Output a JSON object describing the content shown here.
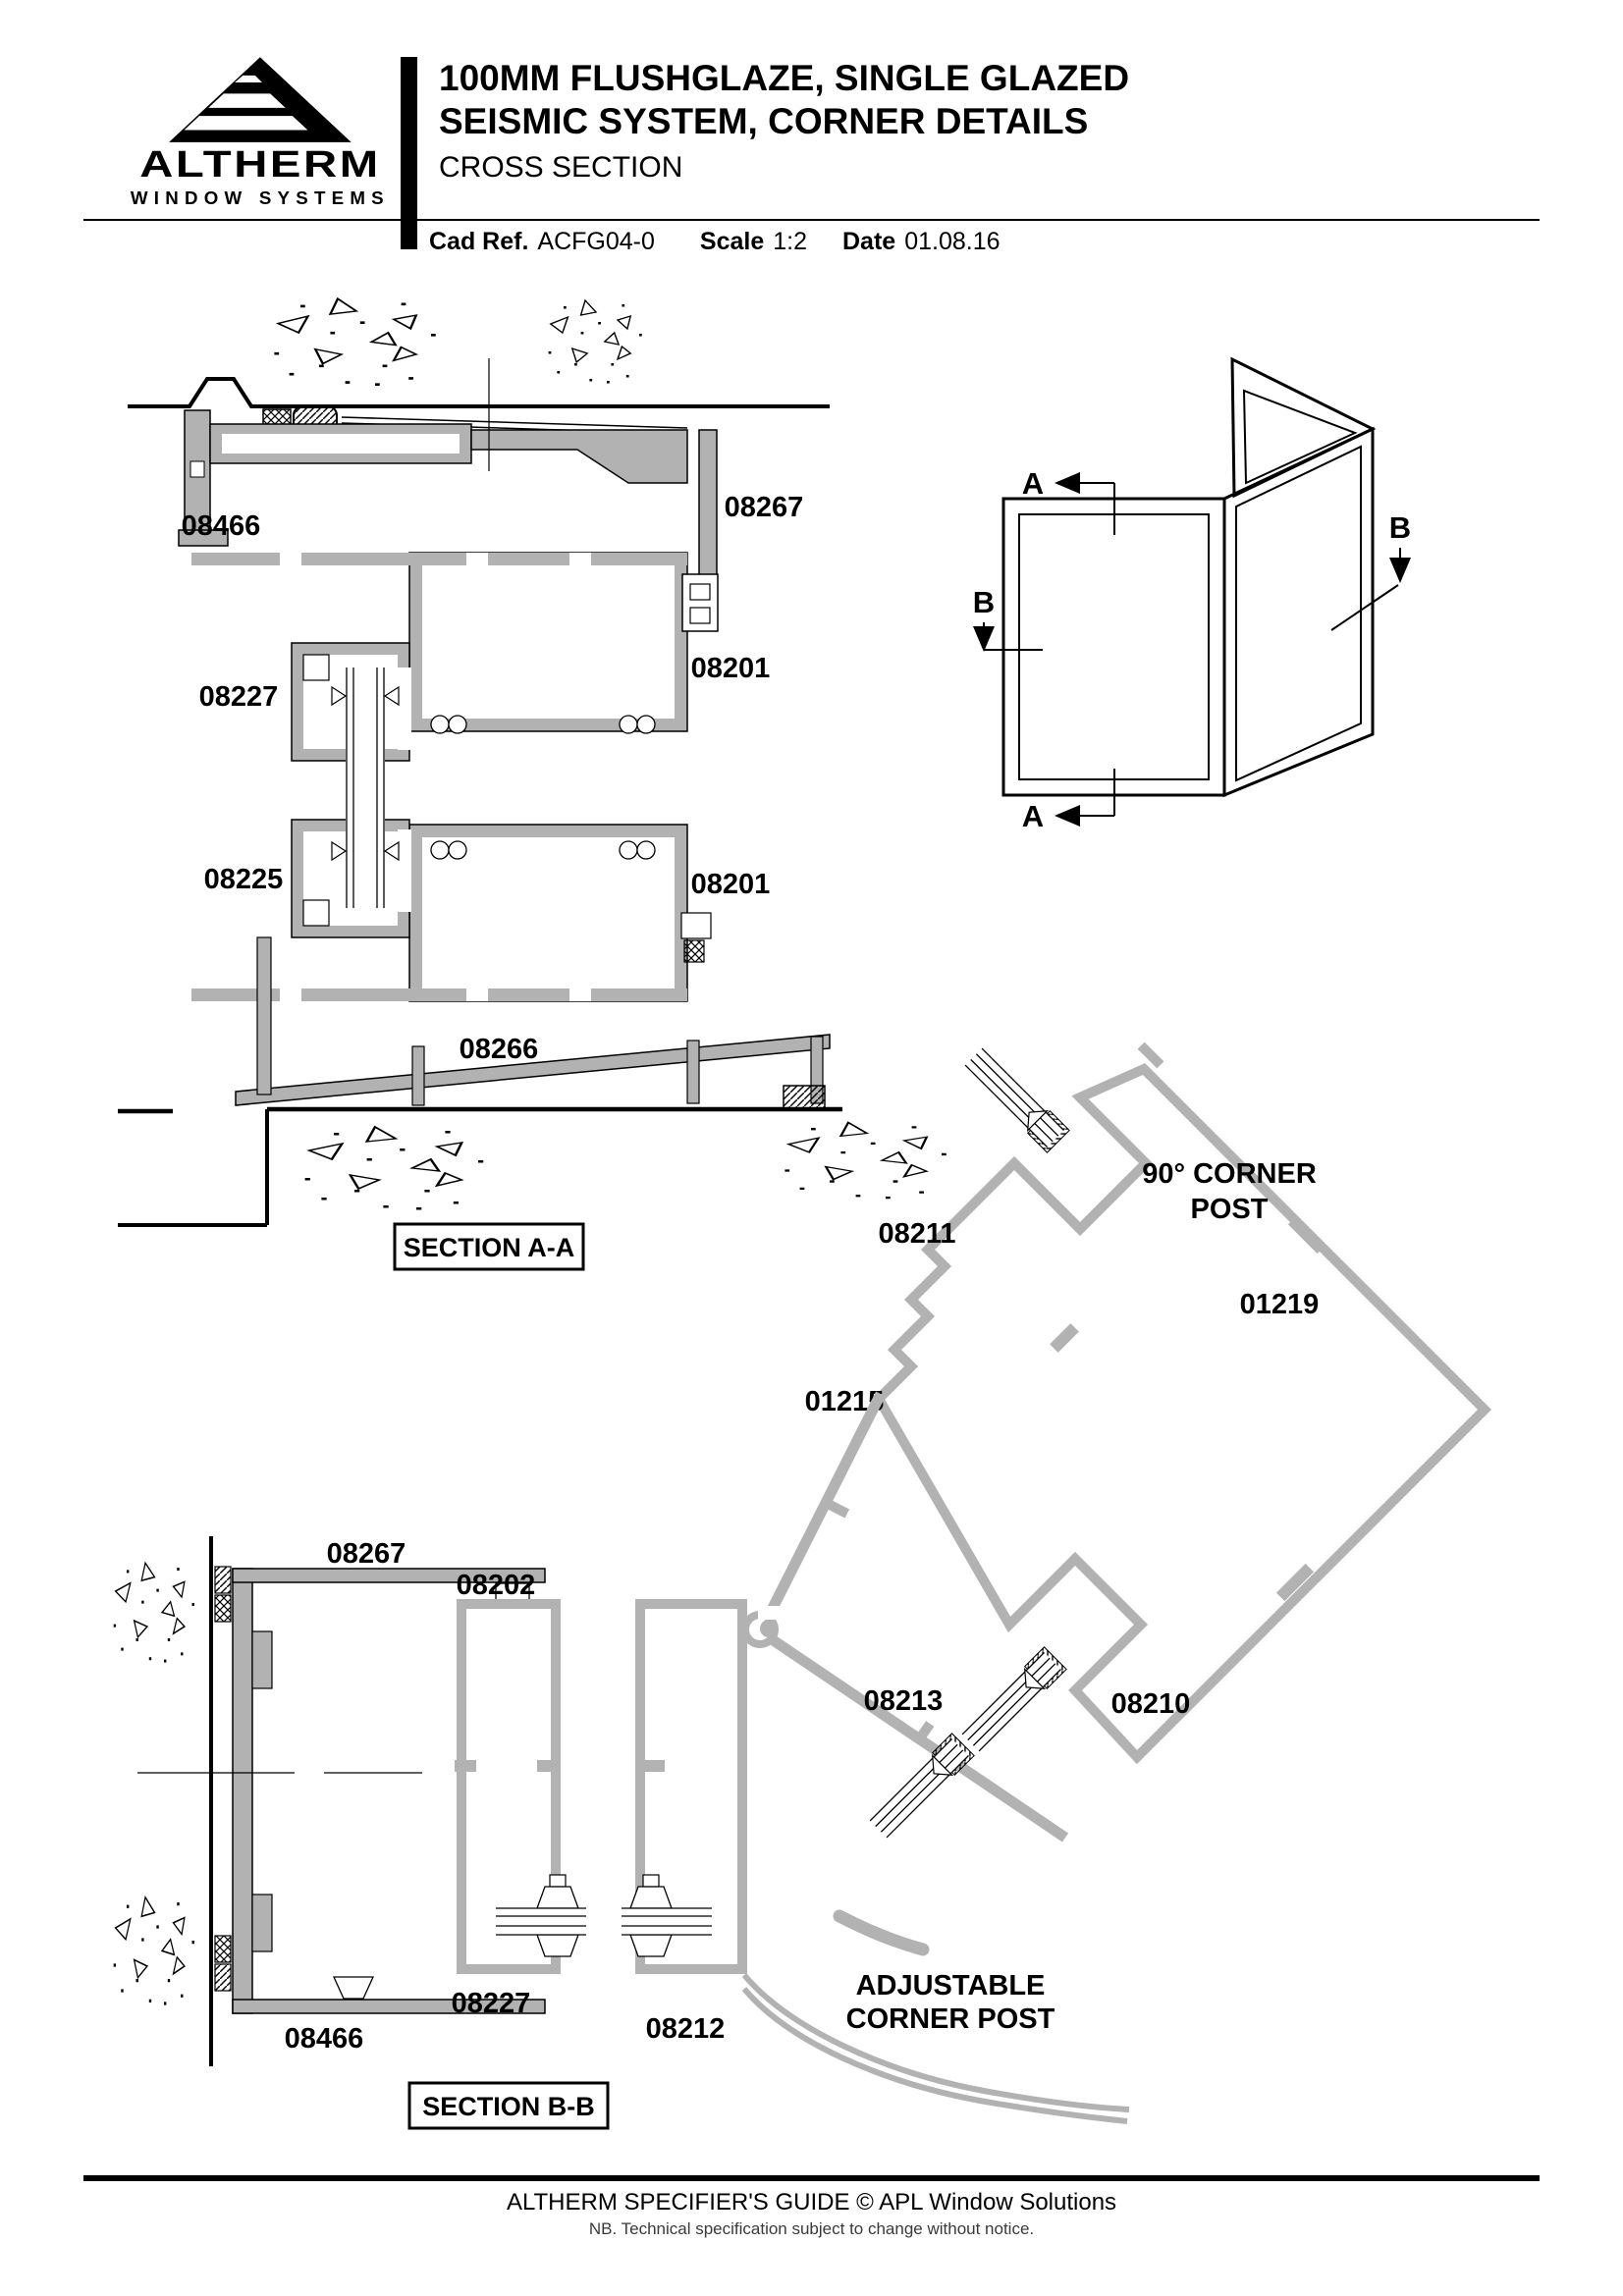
{
  "colors": {
    "ink": "#000000",
    "profile_gray": "#b2b2b2"
  },
  "header": {
    "brand": "ALTHERM",
    "brand_tagline": "WINDOW SYSTEMS",
    "title_line1": "100MM FLUSHGLAZE, SINGLE GLAZED",
    "title_line2": "SEISMIC SYSTEM, CORNER DETAILS",
    "subtitle": "CROSS SECTION",
    "cad_ref_label": "Cad Ref.",
    "cad_ref_value": "ACFG04-0",
    "scale_label": "Scale",
    "scale_value": "1:2",
    "date_label": "Date",
    "date_value": "01.08.16"
  },
  "section_aa": {
    "caption": "SECTION A-A",
    "part_08466": "08466",
    "part_08267": "08267",
    "part_08227": "08227",
    "part_08201_upper": "08201",
    "part_08225": "08225",
    "part_08201_lower": "08201",
    "part_08266": "08266"
  },
  "isometric": {
    "marker_a_top": "A",
    "marker_a_bottom": "A",
    "marker_b_left": "B",
    "marker_b_right": "B"
  },
  "corner_post_90": {
    "title_line1": "90° CORNER",
    "title_line2": "POST",
    "part_08211": "08211",
    "part_01219": "01219",
    "part_01215": "01215",
    "part_08210": "08210"
  },
  "adjustable_post": {
    "title_line1": "ADJUSTABLE",
    "title_line2": "CORNER POST",
    "part_08213": "08213",
    "part_08212": "08212"
  },
  "section_bb": {
    "caption": "SECTION B-B",
    "part_08267": "08267",
    "part_08202": "08202",
    "part_08227": "08227",
    "part_08466": "08466"
  },
  "footer": {
    "line1": "ALTHERM SPECIFIER'S GUIDE  © APL Window Solutions",
    "line2": "NB. Technical specification subject to change without notice."
  }
}
